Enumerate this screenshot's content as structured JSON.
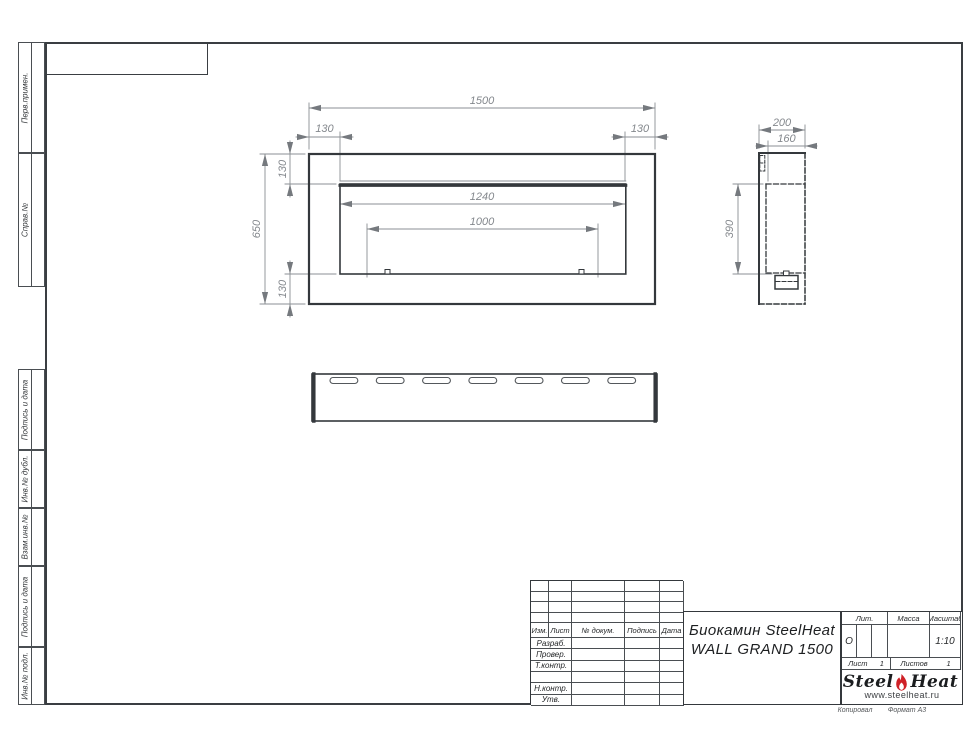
{
  "sheet": {
    "copied_label": "Копировал",
    "format_label": "Формат А3"
  },
  "sidebar": {
    "cells": [
      {
        "label": "Перв.примен."
      },
      {
        "label": "Справ.№"
      },
      {
        "label": "Подпись и дата"
      },
      {
        "label": "Инв.№ дубл."
      },
      {
        "label": "Взам.инв.№"
      },
      {
        "label": "Подпись и дата"
      },
      {
        "label": "Инв.№ подл."
      }
    ]
  },
  "drawing": {
    "front": {
      "overall_width": "1500",
      "left_offset": "130",
      "right_offset": "130",
      "overall_height": "650",
      "top_offset": "130",
      "bottom_offset": "130",
      "opening_width": "1240",
      "burner_width": "1000"
    },
    "side": {
      "depth": "200",
      "inner_depth": "160",
      "opening_height": "390"
    }
  },
  "title_block": {
    "header_cols": [
      "Изм.",
      "Лист",
      "№ докум.",
      "Подпись",
      "Дата"
    ],
    "sign_rows": [
      "Разраб.",
      "Провер.",
      "Т.контр.",
      "",
      "Н.контр.",
      "Утв."
    ],
    "doc_title_line1": "Биокамин SteelHeat",
    "doc_title_line2": "WALL GRAND 1500",
    "lit_label": "Лит.",
    "lit_value": "О",
    "mass_label": "Масса",
    "scale_label": "Масштаб",
    "scale_value": "1:10",
    "sheet_label": "Лист",
    "sheet_value": "1",
    "sheets_label": "Листов",
    "sheets_value": "1",
    "logo": {
      "part1": "Steel",
      "part2": "Heat",
      "url": "www.steelheat.ru",
      "flame_color": "#cf2127"
    }
  }
}
